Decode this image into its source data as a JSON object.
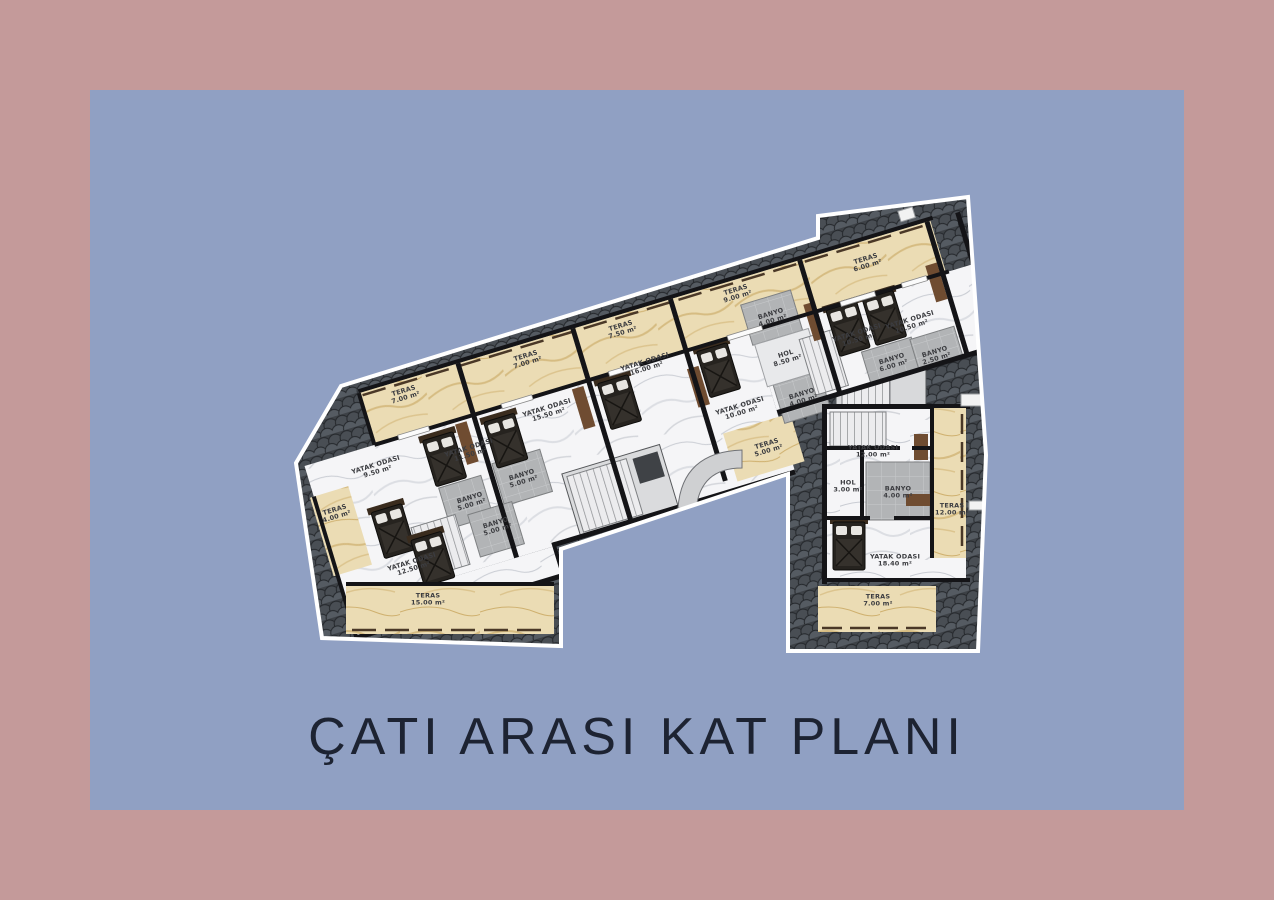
{
  "title": "ÇATI ARASI KAT PLANI",
  "colors": {
    "frame": "#c49a9a",
    "panel": "#90a0c3",
    "roof": "#3d4146",
    "roof_outline": "#ffffff",
    "terrace_marble": "#ebdcb4",
    "room_marble": "#f5f5f7",
    "wet_room": "#b2b4b6",
    "wall": "#141417",
    "title_text": "#1d2332"
  },
  "plan": {
    "rooms": [
      {
        "name": "TERAS",
        "area": "7.00 m²"
      },
      {
        "name": "TERAS",
        "area": "7.00 m²"
      },
      {
        "name": "TERAS",
        "area": "7.50 m²"
      },
      {
        "name": "TERAS",
        "area": "9.00 m²"
      },
      {
        "name": "TERAS",
        "area": "6.00 m²"
      },
      {
        "name": "YATAK ODASI",
        "area": "15.50 m²"
      },
      {
        "name": "YATAK ODASI",
        "area": "11.50 m²"
      },
      {
        "name": "YATAK ODASI",
        "area": "9.50 m²"
      },
      {
        "name": "YATAK ODASI",
        "area": "16.00 m²"
      },
      {
        "name": "YATAK ODASI",
        "area": "10.00 m²"
      },
      {
        "name": "YATAK ODASI",
        "area": "10.50 m²"
      },
      {
        "name": "YATAK ODASI",
        "area": "10.50 m²"
      },
      {
        "name": "BANYO",
        "area": "4.00 m²"
      },
      {
        "name": "HOL",
        "area": "8.50 m²"
      },
      {
        "name": "BANYO",
        "area": "4.00 m²"
      },
      {
        "name": "BANYO",
        "area": "6.00 m²"
      },
      {
        "name": "BANYO",
        "area": "2.50 m²"
      },
      {
        "name": "BANYO",
        "area": "5.00 m²"
      },
      {
        "name": "BANYO",
        "area": "5.00 m²"
      },
      {
        "name": "BANYO",
        "area": "5.00 m²"
      },
      {
        "name": "TERAS",
        "area": "4.00 m²"
      },
      {
        "name": "YATAK ODASI",
        "area": "12.50 m²"
      },
      {
        "name": "TERAS",
        "area": "15.00 m²"
      },
      {
        "name": "TERAS",
        "area": "5.00 m²"
      },
      {
        "name": "YATAK ODASI",
        "area": "12.00 m²"
      },
      {
        "name": "HOL",
        "area": "3.00 m²"
      },
      {
        "name": "BANYO",
        "area": "4.00 m²"
      },
      {
        "name": "TERAS",
        "area": "12.00 m²"
      },
      {
        "name": "YATAK ODASI",
        "area": "18.40 m²"
      },
      {
        "name": "TERAS",
        "area": "7.00 m²"
      }
    ]
  }
}
